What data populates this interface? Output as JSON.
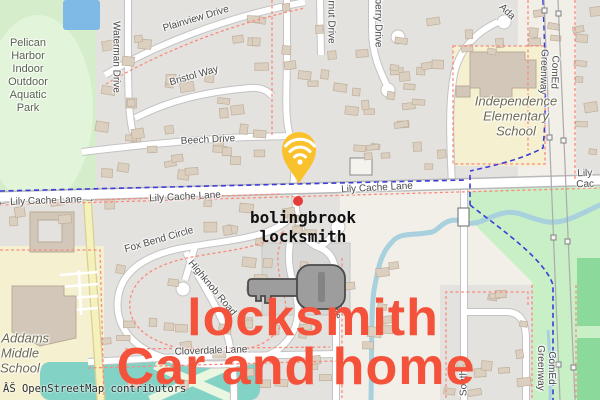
{
  "attribution": "ÂŠ OpenStreetMap contributors",
  "overlay_text": {
    "line1": "locksmith",
    "line2": "Car and home",
    "color": "#F4523B"
  },
  "business_label": {
    "name": "bolingbrook\nlocksmith"
  },
  "marker": {
    "kind": "wifi-pin",
    "color": "#F9C12C"
  },
  "poi": {
    "park": "Pelican\nHarbor\nIndoor\nOutdoor\nAquatic\nPark",
    "elementary_school": "Independence\nElementary\nSchool",
    "middle_school": "e Addams\nMiddle\nSchool"
  },
  "streets": {
    "plainview": "Plainview Drive",
    "waterman": "Waterman Drive",
    "bristol": "Bristol Way",
    "beech": "Beech Drive",
    "walnut_partial": "rnut Drive",
    "berry_partial": "berry Drive",
    "adams_partial": "Ada",
    "comed_top": "ComEd Greenway",
    "lily_left": "← Lily Cache Lane →",
    "lily_mid": "Lily Cache Lane",
    "lily_mid2": "Lily Cache Lane",
    "lily_right": "Lily Cac",
    "fox_bend": "Fox Bend Circle",
    "highknob": "Highknob Road",
    "cloverdale": "Cloverdale Lane",
    "drive_partial": "Drive",
    "south_partial": "South",
    "comed_bottom": "ComEd Greenway"
  },
  "colors": {
    "pin": "#F9C12C",
    "red_dot": "#E63B3B",
    "overlay_red": "#F4523B",
    "key": "#9D9D9D",
    "water": "#A8D0DD",
    "park_green": "#D5EDCA",
    "grass_green": "#C9EFC7",
    "residential": "#E3E2DF",
    "land": "#F2EFE9"
  }
}
